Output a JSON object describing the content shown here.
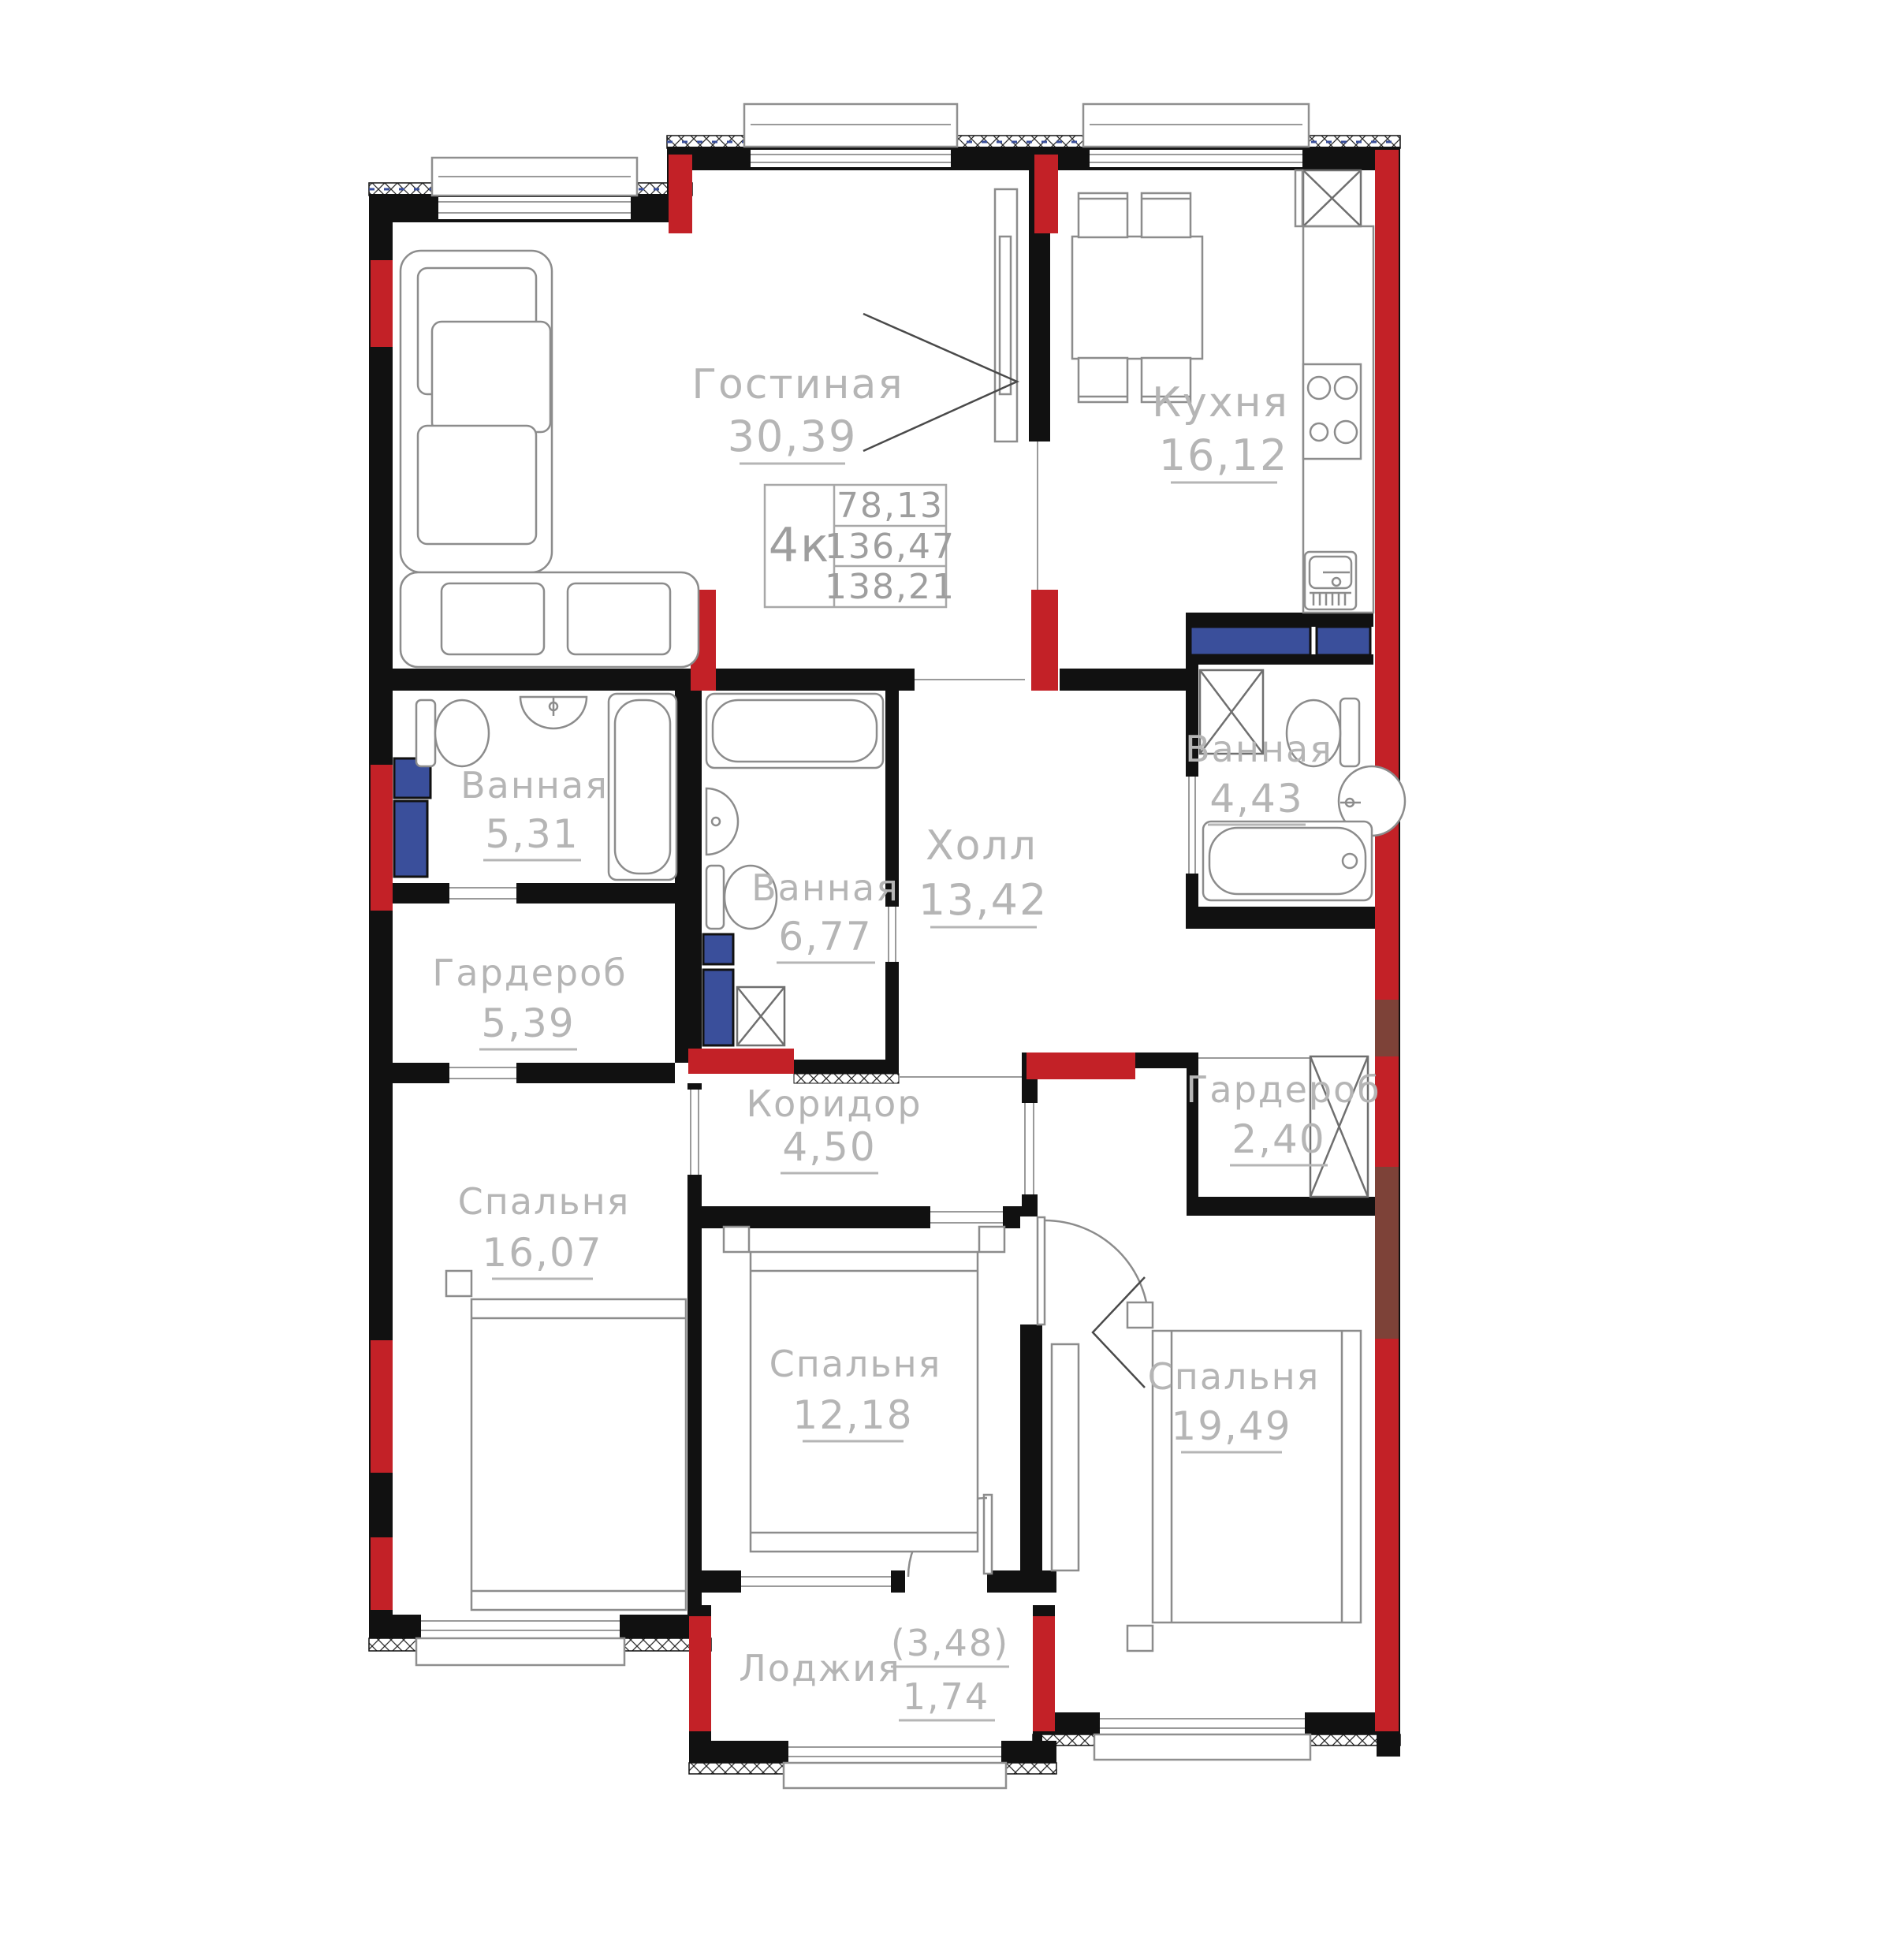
{
  "plan": {
    "title": "4-room apartment floor plan",
    "unit_info": {
      "type_label": "4к",
      "area_line1": "78,13",
      "area_line2": "136,47",
      "area_line3": "138,21"
    },
    "rooms": [
      {
        "id": "living",
        "name": "Гостиная",
        "area": "30,39"
      },
      {
        "id": "kitchen",
        "name": "Кухня",
        "area": "16,12"
      },
      {
        "id": "bath-left",
        "name": "Ванная",
        "area": "5,31"
      },
      {
        "id": "wardrobe-left",
        "name": "Гардероб",
        "area": "5,39"
      },
      {
        "id": "bath-mid",
        "name": "Ванная",
        "area": "6,77"
      },
      {
        "id": "hall",
        "name": "Холл",
        "area": "13,42"
      },
      {
        "id": "bath-right",
        "name": "Ванная",
        "area": "4,43"
      },
      {
        "id": "wardrobe-right",
        "name": "Гардероб",
        "area": "2,40"
      },
      {
        "id": "corridor",
        "name": "Коридор",
        "area": "4,50"
      },
      {
        "id": "bedroom-left",
        "name": "Спальня",
        "area": "16,07"
      },
      {
        "id": "bedroom-mid",
        "name": "Спальня",
        "area": "12,18"
      },
      {
        "id": "bedroom-right",
        "name": "Спальня",
        "area": "19,49"
      },
      {
        "id": "loggia",
        "name": "Лоджия",
        "area_gross": "(3,48)",
        "area": "1,74"
      }
    ],
    "colors": {
      "wall": "#111111",
      "column_red": "#c32127",
      "wall_maroon": "#7d4238",
      "shaft_blue": "#3a4f9b",
      "label_gray": "#b5b5b5",
      "furniture_gray": "#8c8c8c"
    }
  }
}
